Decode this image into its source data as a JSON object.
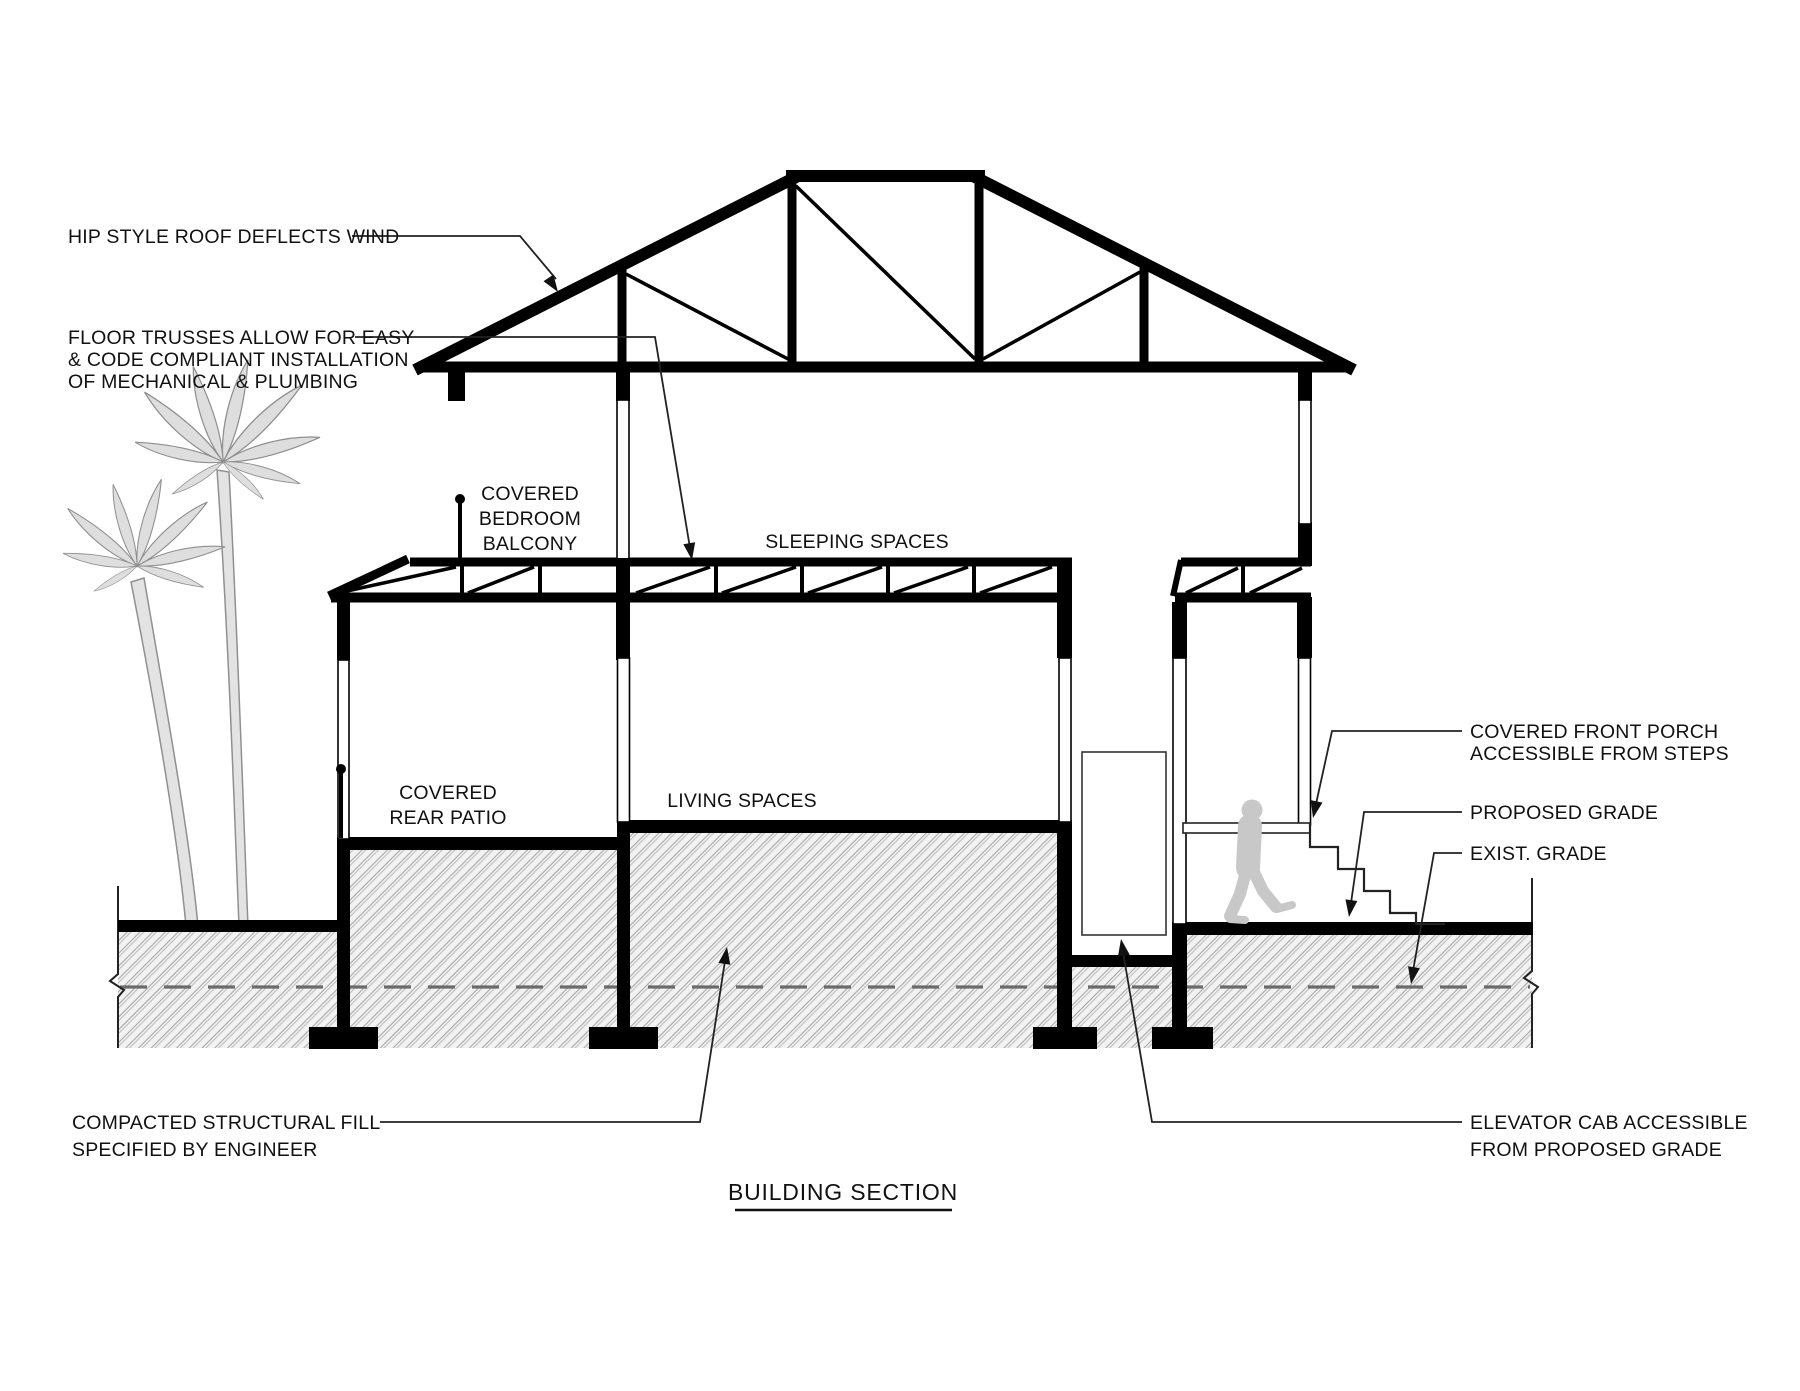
{
  "drawing": {
    "title": "BUILDING SECTION",
    "callouts": {
      "roof": "HIP STYLE ROOF DEFLECTS WIND",
      "floor_trusses": [
        "FLOOR TRUSSES ALLOW FOR EASY",
        "& CODE COMPLIANT INSTALLATION",
        "OF MECHANICAL & PLUMBING"
      ],
      "balcony": [
        "COVERED",
        "BEDROOM",
        "BALCONY"
      ],
      "sleeping": "SLEEPING SPACES",
      "patio": [
        "COVERED",
        "REAR PATIO"
      ],
      "living": "LIVING SPACES",
      "porch": [
        "COVERED FRONT PORCH",
        "ACCESSIBLE FROM STEPS"
      ],
      "proposed_grade": "PROPOSED GRADE",
      "exist_grade": "EXIST. GRADE",
      "structural_fill": [
        "COMPACTED STRUCTURAL FILL",
        "SPECIFIED BY ENGINEER"
      ],
      "elevator": [
        "ELEVATOR CAB ACCESSIBLE",
        "FROM PROPOSED GRADE"
      ]
    },
    "colors": {
      "ink": "#111111",
      "hatch_line": "#a8a8a8",
      "hatch_bg": "#f2f2f2",
      "person_gray": "#c8c8c8",
      "palm_gray": "#dedede"
    }
  }
}
